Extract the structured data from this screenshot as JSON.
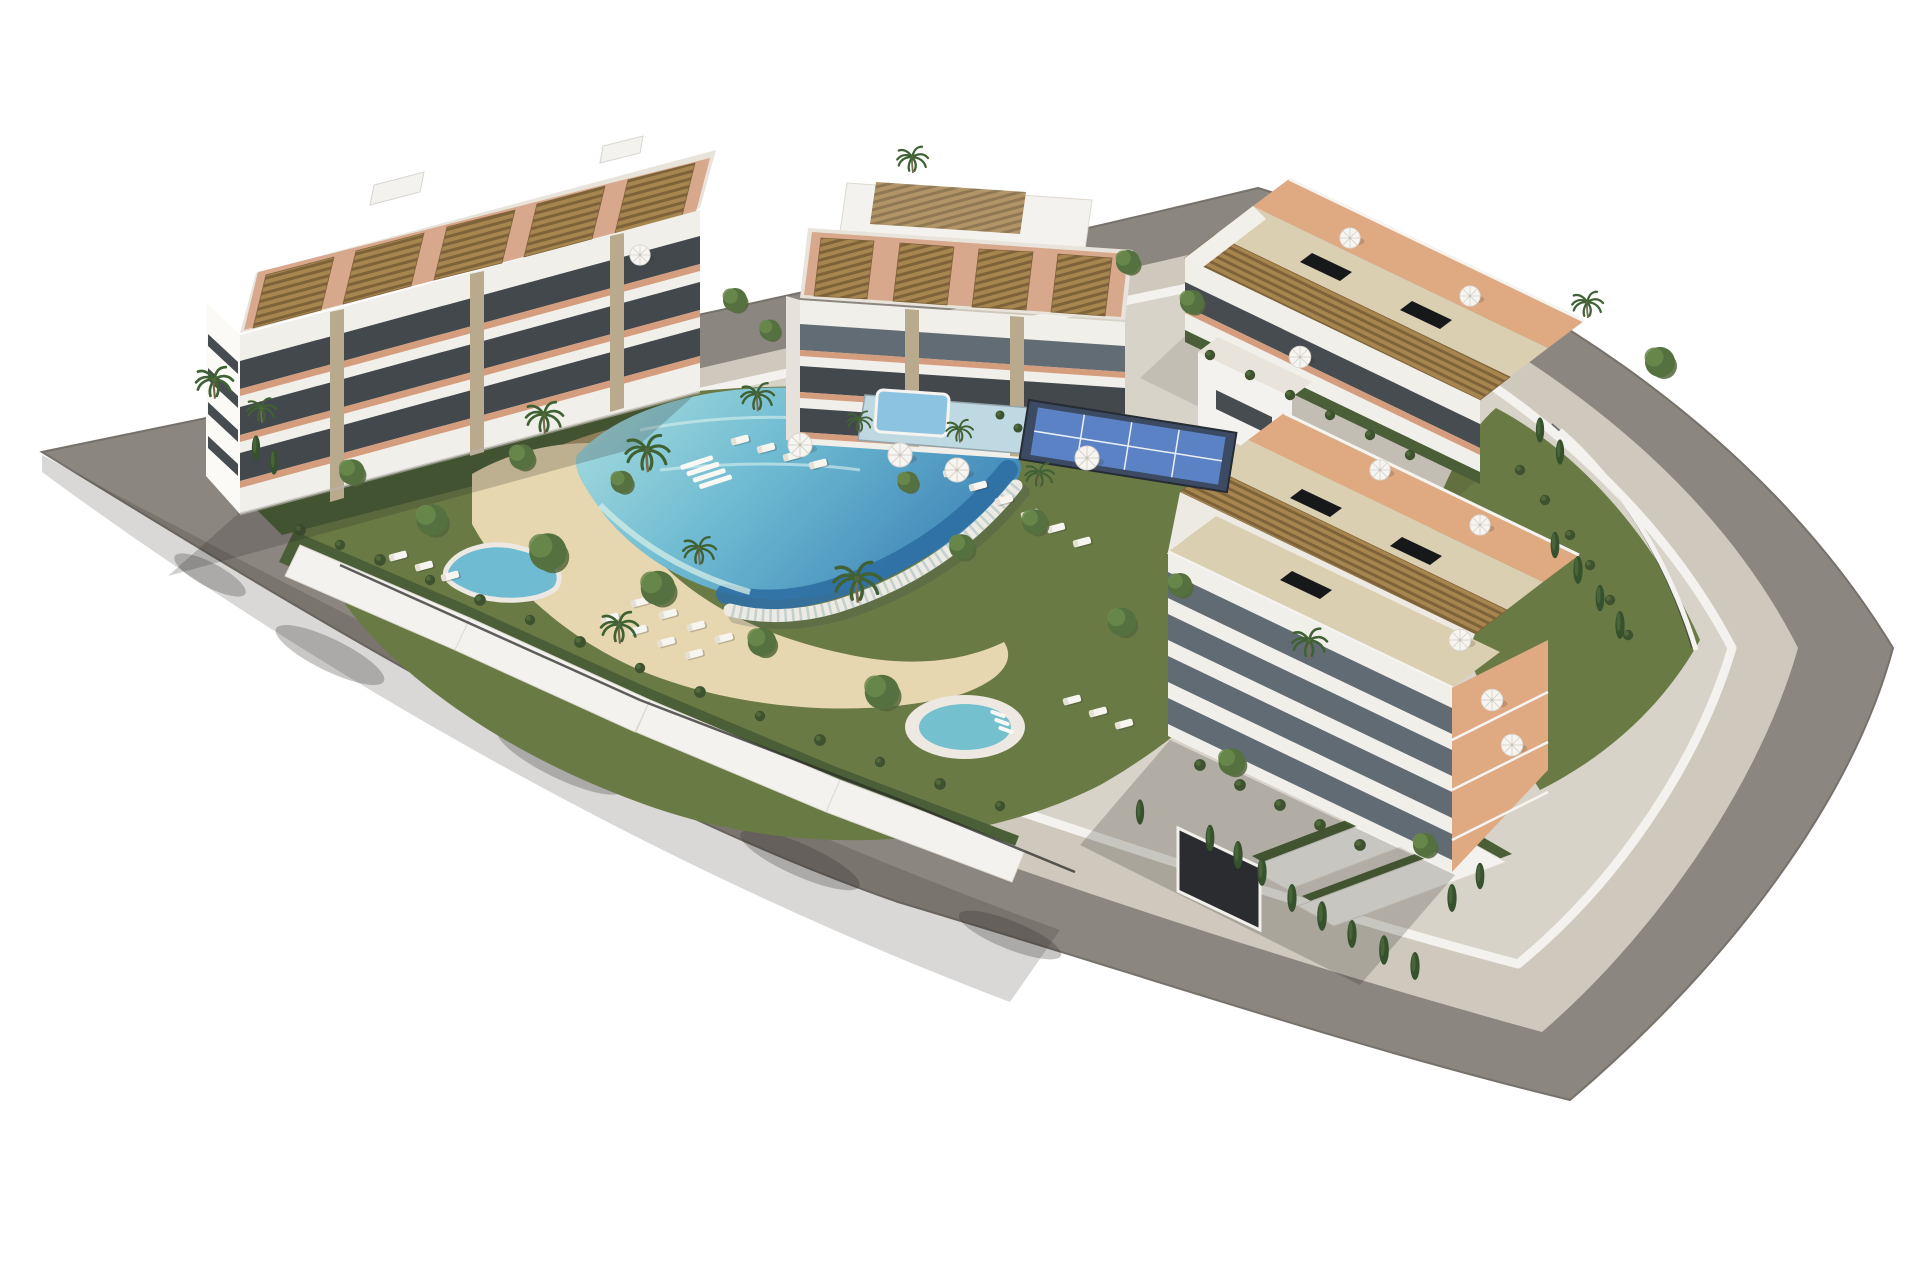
{
  "scene": {
    "type": "architectural-3d-render",
    "description": "Aerial 3D rendering of a modern white residential apartment complex on a rounded corner plot surrounded by a gray perimeter road, with central lagoon pool, beach entry, spa pool, kidney pool, padel court, gardens, palm trees and rooftop pergola terraces",
    "buildings": [
      {
        "id": "west-building",
        "features": [
          "rooftop-pergolas",
          "tiered-balconies",
          "terracotta-terraces",
          "stone-pillars"
        ]
      },
      {
        "id": "north-building",
        "features": [
          "rooftop-pergolas",
          "stepped-penthouse",
          "tiered-balconies"
        ]
      },
      {
        "id": "east-building",
        "features": [
          "long-pergola-rows",
          "roof-skylights",
          "glass-band-facade",
          "street-facing-terraces",
          "garage-entrance"
        ]
      }
    ],
    "amenities": [
      "lagoon-pool",
      "infinity-edge",
      "beach-entry",
      "spa-pool",
      "kidney-pool",
      "kids-pool",
      "padel-court",
      "sun-loungers",
      "parasols",
      "gardens",
      "perimeter-road",
      "perimeter-walkway"
    ],
    "palette": {
      "sky": "#ffffff",
      "road": "#8C8680",
      "road_line": "#76716B",
      "walkway": "#CFC8BD",
      "site": "#D8D3C9",
      "wall": "#F4F2EE",
      "lawn": "#6A7A45",
      "lawn_dark": "#55663C",
      "shrub": "#3E5230",
      "shrub_band": "#4A5F37",
      "sand": "#E6D7B0",
      "pool_shallow": "#A7DCDE",
      "pool_mid": "#6FBBD2",
      "pool_deep": "#3F85B8",
      "pool_deepest": "#2F6FA3",
      "pool_wall": "#EDEAE3",
      "spa_water": "#74C0CE",
      "rim": "#EDE9E2",
      "kids_pool": "#8CC3E0",
      "kids_deck": "#BFD9E2",
      "padel_court": "#5B82C4",
      "padel_surround": "#3C4A63",
      "deck_wood": "#B89B6F",
      "building_white": "#F1EFEA",
      "building_shade": "#E6E2DB",
      "band_dark": "#343A3F",
      "glass": "#5A646E",
      "terracotta": "#D49E7E",
      "terrace_light": "#DFA982",
      "pergola": "#A6854F",
      "pergola_line": "#7E6239",
      "roof_beige": "#DBCFB2",
      "roof_pale": "#E9E4DB",
      "stone": "#B9AA8E",
      "skylight": "#17181A",
      "palm": "#3F6134",
      "tree": "#55713F",
      "tree_light": "#6B8A4C",
      "cypress": "#35512E",
      "trunk": "#7A6A4F",
      "lounger": "#F7F5F0",
      "shadow": "#2B2723"
    },
    "stamps": {
      "mid": {
        "lounger": [
          [
            740,
            440,
            1,
            -15
          ],
          [
            766,
            448,
            1,
            -15
          ],
          [
            792,
            456,
            1,
            -15
          ],
          [
            818,
            464,
            1,
            -15
          ],
          [
            952,
            472,
            1,
            -15
          ],
          [
            978,
            486,
            1,
            -15
          ],
          [
            1004,
            500,
            1,
            -15
          ],
          [
            1030,
            514,
            1,
            -15
          ],
          [
            1056,
            528,
            1,
            -15
          ],
          [
            1082,
            542,
            1,
            -15
          ],
          [
            640,
            602,
            1,
            -15
          ],
          [
            668,
            614,
            1,
            -15
          ],
          [
            696,
            626,
            1,
            -15
          ],
          [
            724,
            638,
            1,
            -15
          ],
          [
            610,
            618,
            1,
            -15
          ],
          [
            638,
            630,
            1,
            -15
          ],
          [
            666,
            642,
            1,
            -15
          ],
          [
            694,
            654,
            1,
            -15
          ],
          [
            1072,
            700,
            1,
            -15
          ],
          [
            1098,
            712,
            1,
            -15
          ],
          [
            1124,
            724,
            1,
            -15
          ],
          [
            398,
            556,
            1,
            -15
          ],
          [
            424,
            566,
            1,
            -15
          ],
          [
            450,
            576,
            1,
            -15
          ]
        ],
        "cabana": [
          [
            928,
            392,
            1,
            4
          ],
          [
            968,
            404,
            1,
            4
          ]
        ],
        "shrub": [
          [
            300,
            530,
            0.9,
            0
          ],
          [
            340,
            545,
            0.8,
            0
          ],
          [
            380,
            560,
            0.9,
            0
          ],
          [
            430,
            580,
            0.8,
            0
          ],
          [
            480,
            600,
            0.9,
            0
          ],
          [
            530,
            620,
            0.8,
            0
          ],
          [
            580,
            642,
            0.9,
            0
          ],
          [
            640,
            668,
            0.8,
            0
          ],
          [
            700,
            692,
            0.9,
            0
          ],
          [
            760,
            716,
            0.8,
            0
          ],
          [
            820,
            740,
            0.9,
            0
          ],
          [
            880,
            762,
            0.8,
            0
          ],
          [
            940,
            784,
            0.9,
            0
          ],
          [
            1000,
            806,
            0.8,
            0
          ]
        ]
      },
      "back": {
        "cypress": [
          [
            882,
            202,
            1,
            0
          ],
          [
            900,
            209,
            1.05,
            0
          ],
          [
            918,
            215,
            1,
            0
          ],
          [
            936,
            221,
            1.05,
            0
          ],
          [
            1540,
            430,
            0.9,
            0
          ],
          [
            1560,
            452,
            0.9,
            0
          ]
        ],
        "palm": [
          [
            913,
            170,
            0.75,
            0
          ]
        ]
      },
      "front": {
        "tree": [
          [
            432,
            520,
            1.05,
            0
          ],
          [
            548,
            552,
            1.25,
            0
          ],
          [
            658,
            588,
            1.15,
            0
          ],
          [
            762,
            642,
            0.95,
            0
          ],
          [
            882,
            692,
            1.15,
            0
          ],
          [
            962,
            547,
            0.85,
            0
          ],
          [
            1122,
            622,
            0.95,
            0
          ],
          [
            522,
            457,
            0.85,
            0
          ],
          [
            622,
            482,
            0.75,
            0
          ],
          [
            1035,
            522,
            0.85,
            0
          ],
          [
            1232,
            762,
            0.9,
            0
          ],
          [
            1425,
            845,
            0.8,
            0
          ],
          [
            352,
            472,
            0.85,
            0
          ],
          [
            908,
            482,
            0.7,
            0
          ],
          [
            1180,
            585,
            0.8,
            0
          ],
          [
            735,
            300,
            0.8,
            0
          ],
          [
            770,
            330,
            0.7,
            0
          ],
          [
            1128,
            262,
            0.8,
            0
          ],
          [
            1192,
            302,
            0.8,
            0
          ],
          [
            1660,
            362,
            1.0,
            0
          ]
        ],
        "palm": [
          [
            648,
            468,
            1.05,
            0
          ],
          [
            858,
            598,
            1.15,
            0
          ],
          [
            758,
            408,
            0.8,
            0
          ],
          [
            860,
            430,
            0.6,
            0
          ],
          [
            960,
            440,
            0.65,
            0
          ],
          [
            1040,
            485,
            0.7,
            0
          ],
          [
            545,
            430,
            0.9,
            0
          ],
          [
            215,
            395,
            0.9,
            0
          ],
          [
            262,
            420,
            0.7,
            0
          ],
          [
            700,
            562,
            0.8,
            0
          ],
          [
            1310,
            655,
            0.85,
            0
          ],
          [
            1588,
            315,
            0.75,
            0
          ],
          [
            620,
            640,
            0.9,
            0
          ]
        ],
        "cypress": [
          [
            1292,
            898,
            1,
            0
          ],
          [
            1322,
            916,
            1.05,
            0
          ],
          [
            1352,
            934,
            1,
            0
          ],
          [
            1384,
            950,
            1.05,
            0
          ],
          [
            1415,
            966,
            1,
            0
          ],
          [
            1452,
            898,
            1,
            0
          ],
          [
            1480,
            876,
            0.95,
            0
          ],
          [
            1262,
            872,
            1,
            0
          ],
          [
            1210,
            838,
            0.95,
            0
          ],
          [
            1238,
            855,
            1,
            0
          ],
          [
            1140,
            812,
            0.9,
            0
          ],
          [
            1555,
            545,
            0.95,
            0
          ],
          [
            1578,
            570,
            1,
            0
          ],
          [
            1600,
            598,
            0.95,
            0
          ],
          [
            1620,
            625,
            1,
            0
          ],
          [
            256,
            448,
            0.9,
            0
          ],
          [
            274,
            462,
            0.9,
            0
          ]
        ],
        "parasol": [
          [
            800,
            445,
            1,
            0
          ],
          [
            900,
            455,
            1,
            0
          ],
          [
            957,
            470,
            1,
            0
          ],
          [
            1087,
            458,
            1,
            0
          ],
          [
            1300,
            357,
            0.9,
            0
          ],
          [
            1350,
            238,
            0.85,
            0
          ],
          [
            1470,
            296,
            0.85,
            0
          ],
          [
            1380,
            470,
            0.85,
            0
          ],
          [
            1480,
            525,
            0.85,
            0
          ],
          [
            1492,
            700,
            0.9,
            0
          ],
          [
            1512,
            745,
            0.9,
            0
          ],
          [
            640,
            255,
            0.85,
            0
          ],
          [
            1460,
            640,
            0.9,
            0
          ]
        ],
        "shrub": [
          [
            1210,
            355,
            0.8,
            0
          ],
          [
            1250,
            375,
            0.8,
            0
          ],
          [
            1290,
            395,
            0.8,
            0
          ],
          [
            1330,
            415,
            0.8,
            0
          ],
          [
            1370,
            435,
            0.8,
            0
          ],
          [
            1410,
            455,
            0.8,
            0
          ],
          [
            1200,
            765,
            0.9,
            0
          ],
          [
            1240,
            785,
            0.9,
            0
          ],
          [
            1280,
            805,
            0.9,
            0
          ],
          [
            1320,
            825,
            0.9,
            0
          ],
          [
            1360,
            845,
            0.9,
            0
          ],
          [
            1520,
            470,
            0.8,
            0
          ],
          [
            1545,
            500,
            0.8,
            0
          ],
          [
            1570,
            535,
            0.8,
            0
          ],
          [
            1590,
            565,
            0.8,
            0
          ],
          [
            1610,
            600,
            0.8,
            0
          ],
          [
            1628,
            635,
            0.8,
            0
          ],
          [
            1018,
            428,
            0.7,
            0
          ],
          [
            1000,
            415,
            0.7,
            0
          ]
        ]
      }
    }
  }
}
